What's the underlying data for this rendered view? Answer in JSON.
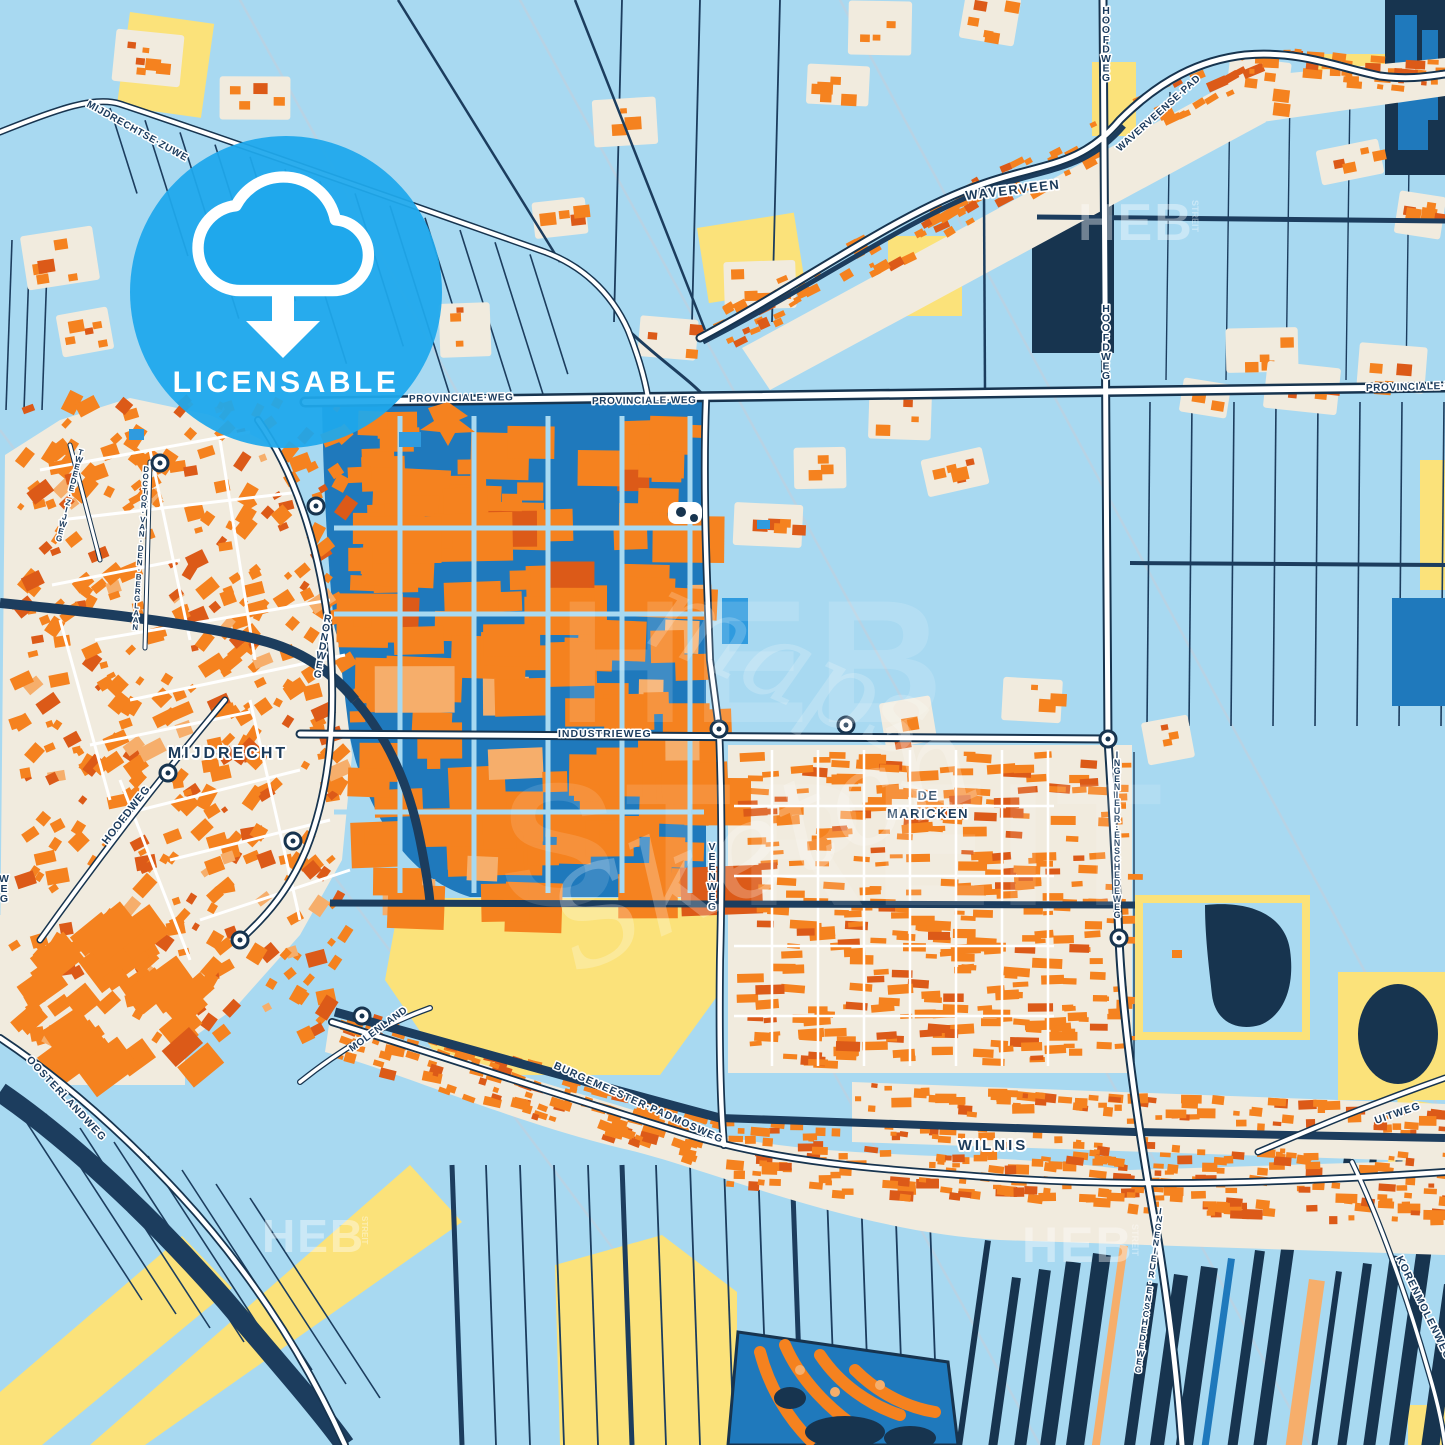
{
  "colors": {
    "bg": "#A8D9F1",
    "navy": "#17344F",
    "navyLine": "#1C3D5E",
    "midBlue": "#1F79BC",
    "brightBlue": "#2F9BDF",
    "badgeBlue": "#1FA8EC",
    "orange": "#F5821F",
    "orangeDark": "#DC5A18",
    "peach": "#F6AE6B",
    "cream": "#F1EBDE",
    "yellow": "#FBE27A",
    "white": "#FFFFFF",
    "label": "#1C3C5E",
    "faint": "#C5CFDC"
  },
  "badge": {
    "label": "LICENSABLE",
    "icon": "cloud-download-icon"
  },
  "watermark": {
    "brand": "HEB",
    "brand_suffix": "STREIT",
    "big_top": "HEB",
    "big_bottom": "STREIT",
    "script": "Sketch",
    "script2": "maps_"
  },
  "labels": {
    "mijdrechtse_zuwe": "MIJDRECHTSE·ZUWE",
    "waverveen": "WAVERVEEN",
    "waverveense_pad": "WAVERVEENSE·PAD",
    "hoofdweg": "HOOFDWEG",
    "provinciale_weg": "PROVINCIALE·WEG",
    "tweede_zijweg": "TWEEDE ZIJWEG",
    "doctor_van_den_berglaan": "DOCTOR VAN DEN BERGLAAN",
    "rondweg": "RONDWEG",
    "mijdrecht": "MIJDRECHT",
    "industrieweg": "INDUSTRIEWEG",
    "veenweg": "VEENWEG",
    "de_maricken_line1": "DE",
    "de_maricken_line2": "MARICKEN",
    "ingenieur_enschedeweg": "INGENIEUR ENSCHEDEWEG",
    "molenland": "MOLENLAND",
    "burgemeester_padmosweg": "BURGEMEESTER·PADMOSWEG",
    "wilnis": "WILNIS",
    "oosterlandweg": "OOSTERLANDWEG",
    "uitweg": "UITWEG",
    "korenmolenweg": "KORENMOLENWEG",
    "weg_partial": "WEG"
  }
}
